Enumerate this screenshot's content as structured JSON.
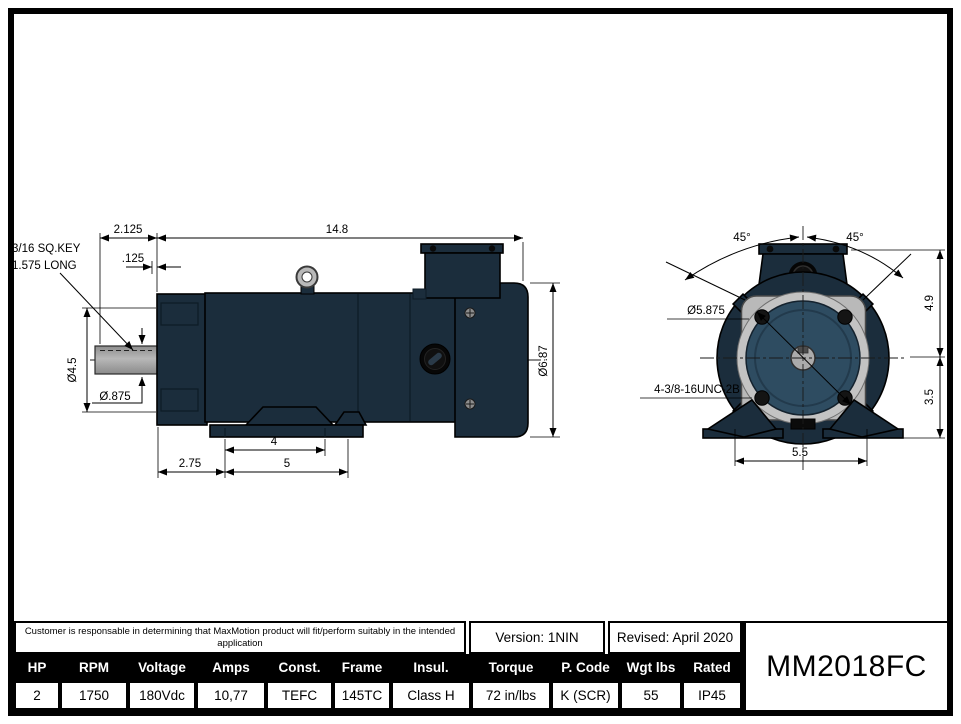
{
  "drawing": {
    "colors": {
      "motor_body": "#1b2d3c",
      "flange_face": "#b9b9b9",
      "pilot_recess": "#2e4c61",
      "shaft": "#a9a9a9",
      "lines": "#000000"
    },
    "side": {
      "key_note1": "3/16 SQ.KEY",
      "key_note2": "1.575 LONG",
      "d2125": "2.125",
      "d148": "14.8",
      "d125": ".125",
      "d45": "Ø4.5",
      "d875": "Ø.875",
      "d275": "2.75",
      "d4": "4",
      "d5": "5",
      "d687": "Ø6.87"
    },
    "front": {
      "angle_l": "45°",
      "angle_r": "45°",
      "bolt_circle": "Ø5.875",
      "thread": "4-3/8-16UNC-2B",
      "d49": "4.9",
      "d35": "3.5",
      "d55": "5.5"
    }
  },
  "title_block": {
    "disclaimer_line1": "Customer is responsable in determining that MaxMotion product will fit/perform suitably in the intended",
    "disclaimer_line2": "application",
    "version": "Version: 1NIN",
    "revised": "Revised: April 2020",
    "model": "MM2018FC",
    "spec_columns": [
      "HP",
      "RPM",
      "Voltage",
      "Amps",
      "Const.",
      "Frame",
      "Insul.",
      "Torque",
      "P. Code",
      "Wgt lbs",
      "Rated"
    ],
    "spec_values": [
      "2",
      "1750",
      "180Vdc",
      "10,77",
      "TEFC",
      "145TC",
      "Class H",
      "72 in/lbs",
      "K (SCR)",
      "55",
      "IP45"
    ]
  }
}
